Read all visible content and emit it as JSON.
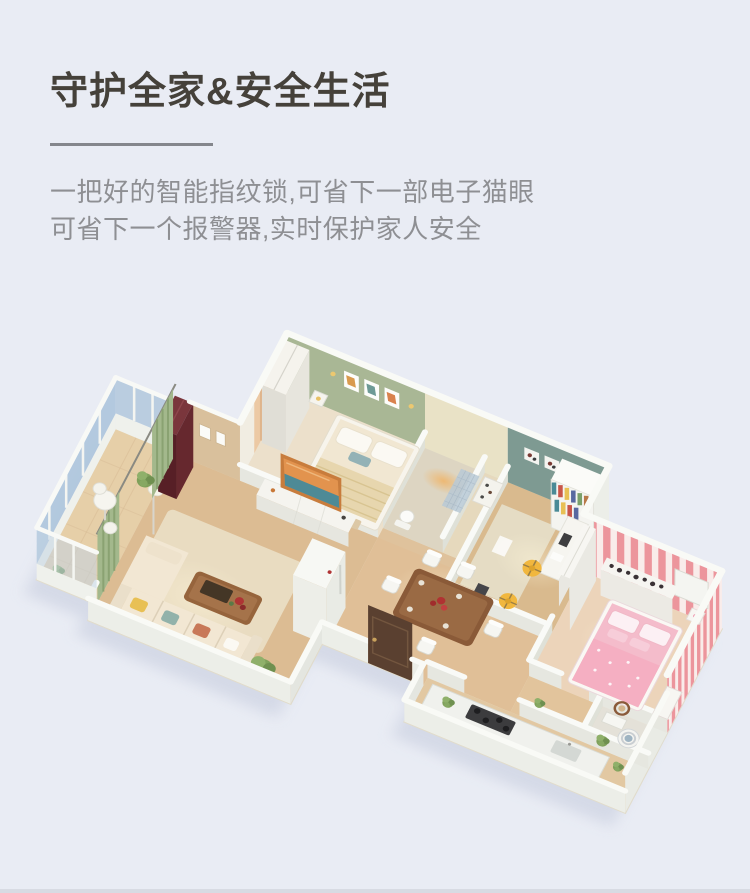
{
  "page": {
    "background_color": "#e9ecf4",
    "bottom_border_color": "#d8dbe3"
  },
  "header": {
    "title": "守护全家&安全生活",
    "description_line1": "一把好的智能指纹锁,可省下一部电子猫眼",
    "description_line2": "可省下一个报警器,实时保护家人安全",
    "title_color": "#45413a",
    "description_color": "#8e8f93",
    "divider_color": "#84868c"
  },
  "floorplan": {
    "type": "3d-isometric-apartment-render",
    "rooms": [
      "master-bedroom",
      "bathroom",
      "hall-closet",
      "study",
      "kids-bedroom",
      "corridor",
      "dining-room",
      "living-room",
      "balcony-sunroom",
      "kitchen",
      "utility-room",
      "entry"
    ],
    "features": [
      "entry-door",
      "double-bed",
      "wardrobe",
      "wall-pictures",
      "toilet",
      "bookshelf",
      "desk",
      "yellow-office-chairs",
      "pink-striped-wall",
      "pink-bed",
      "dresser",
      "dining-table",
      "dining-chairs",
      "fridge-cabinet",
      "tv-console",
      "orange-tv",
      "cream-l-sofa",
      "coffee-table",
      "green-curtains",
      "floor-lamp",
      "burgundy-cabinet",
      "balcony-windows",
      "bistro-table",
      "plants",
      "kitchen-counter",
      "stove",
      "sink",
      "washing-machine"
    ],
    "palette": {
      "wall_white": "#f8f9f6",
      "wood_floor": "#ddbd92",
      "master_floor": "#ece0cb",
      "green_wall": "#a9b795",
      "teal_wall": "#7e9a92",
      "pink_stripe": "#ec959c",
      "pink_bed": "#f4bccb",
      "glass_blue": "#b5cade",
      "door_brown": "#5a4030",
      "sofa_cream": "#f2e7d3",
      "chair_yellow": "#f1b73e",
      "table_brown": "#8a5a38",
      "shadow": "#d2d7e5"
    }
  }
}
